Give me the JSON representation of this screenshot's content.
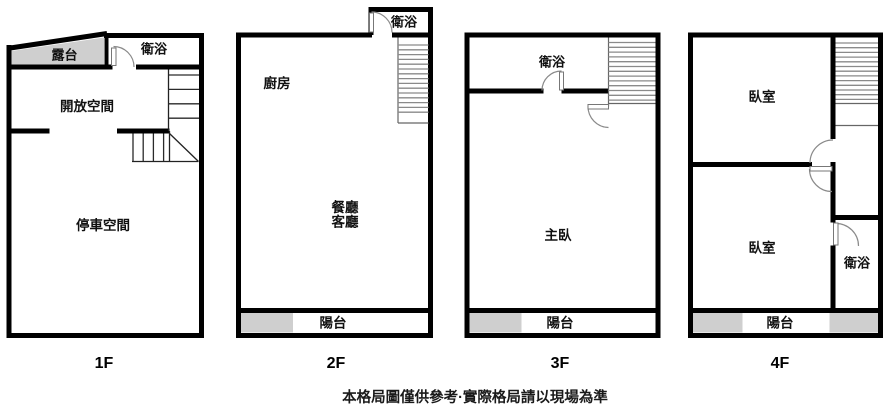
{
  "title": "apartment-floor-plans",
  "disclaimer": "本格局圖僅供參考·實際格局請以現場為準",
  "colors": {
    "wall": "#000000",
    "shaded_area": "#cfcfcf",
    "stair_tread": "#8a8a8a"
  },
  "floors": [
    {
      "label": "1F",
      "rooms": {
        "terrace": "露台",
        "bathroom": "衛浴",
        "open_space": "開放空間",
        "parking": "停車空間"
      }
    },
    {
      "label": "2F",
      "rooms": {
        "bathroom": "衛浴",
        "kitchen": "廚房",
        "dining": "餐廳",
        "living": "客廳",
        "balcony": "陽台"
      }
    },
    {
      "label": "3F",
      "rooms": {
        "bathroom": "衛浴",
        "master_bedroom": "主臥",
        "balcony": "陽台"
      }
    },
    {
      "label": "4F",
      "rooms": {
        "bedroom_upper": "臥室",
        "bedroom_lower": "臥室",
        "bathroom": "衛浴",
        "balcony": "陽台"
      }
    }
  ]
}
